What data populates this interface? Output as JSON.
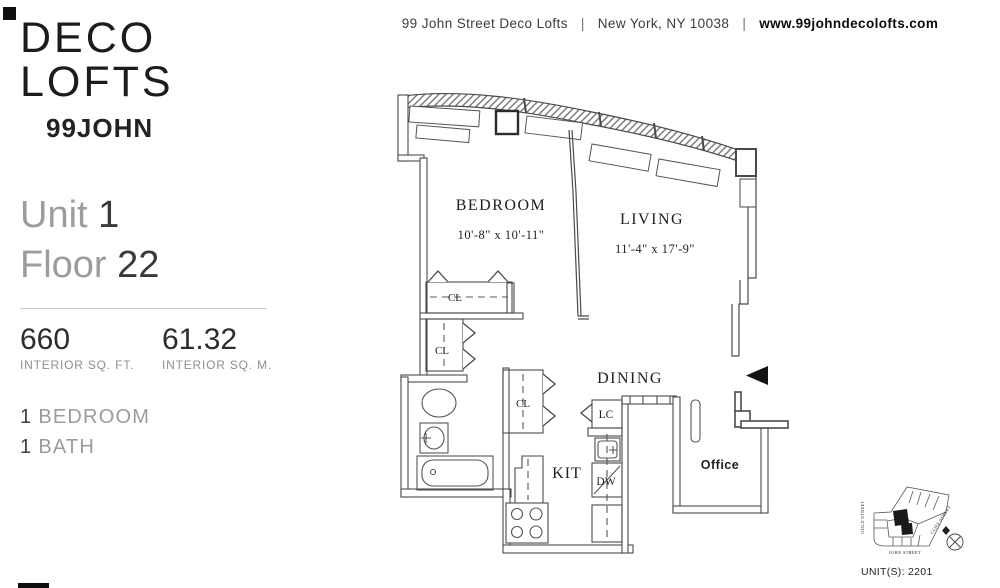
{
  "brand": {
    "line1": "DECO",
    "line2": "LOFTS",
    "line3": "99JOHN"
  },
  "header": {
    "address": "99 John Street Deco Lofts",
    "separator": "|",
    "city": "New York, NY 10038",
    "website": "www.99johndecolofts.com"
  },
  "unit": {
    "unit_label": "Unit",
    "unit_number": "1",
    "floor_label": "Floor",
    "floor_number": "22",
    "area_ft_value": "660",
    "area_ft_label": "INTERIOR SQ. FT.",
    "area_m_value": "61.32",
    "area_m_label": "INTERIOR SQ. M.",
    "beds_count": "1",
    "beds_label": "BEDROOM",
    "baths_count": "1",
    "baths_label": "BATH"
  },
  "floorplan": {
    "bedroom_name": "BEDROOM",
    "bedroom_dims": "10'-8\" x 10'-11\"",
    "living_name": "LIVING",
    "living_dims": "11'-4\" x 17'-9\"",
    "dining_name": "DINING",
    "kitchen_name": "KIT",
    "office_name": "Office",
    "closet_label": "CL",
    "linen_closet_label": "LC",
    "dishwasher_label": "DW"
  },
  "keymap": {
    "street_left": "GOLD STREET",
    "street_bottom": "JOHN STREET",
    "street_right": "CLIFF STREET",
    "caption": "UNIT(S): 2201"
  }
}
